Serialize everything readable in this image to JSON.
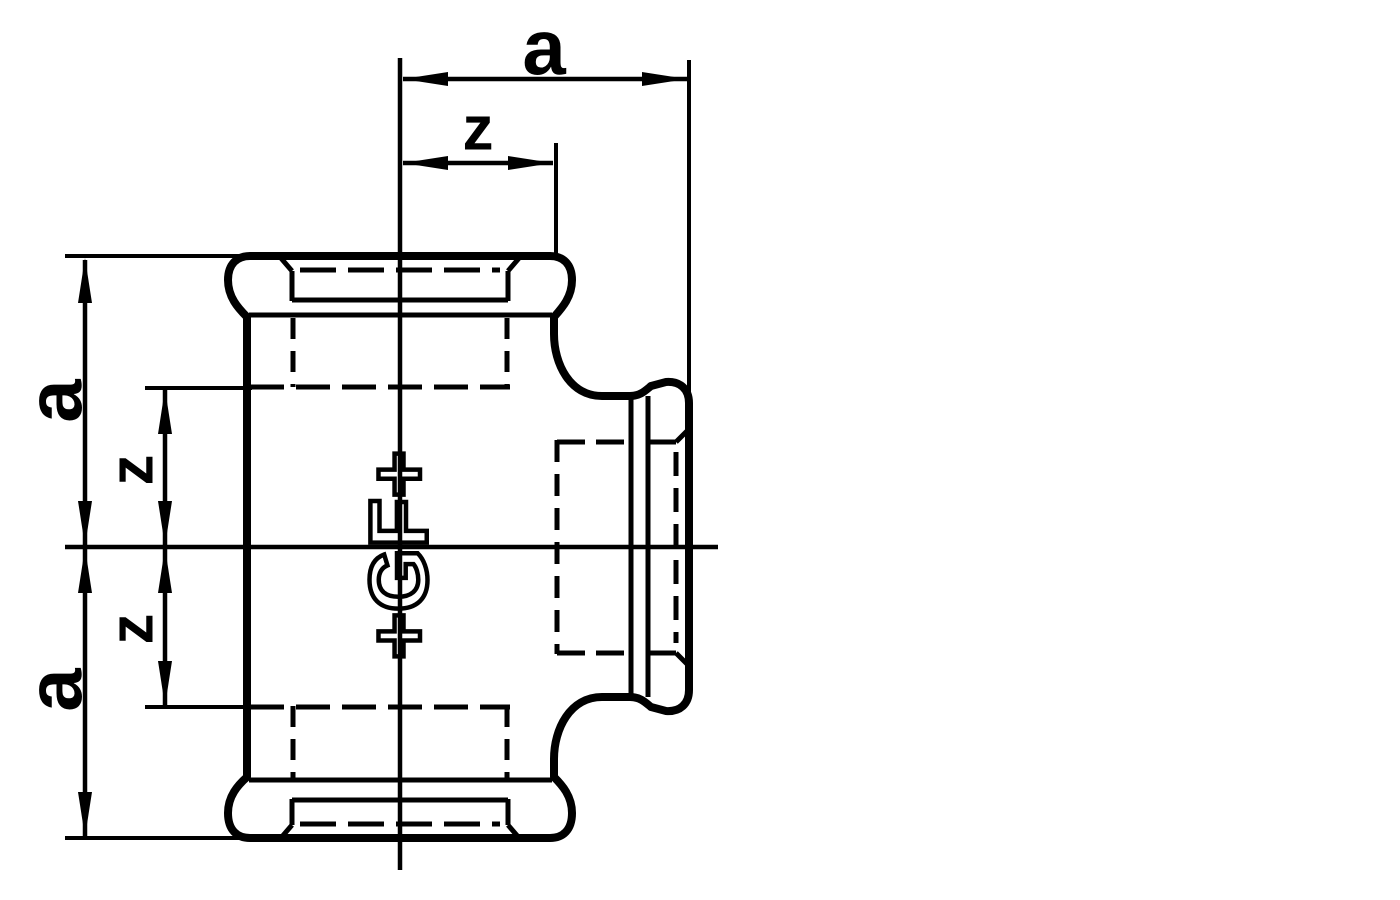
{
  "colors": {
    "ink": "#000000",
    "background": "#ffffff"
  },
  "logo": {
    "text": "+GF+"
  },
  "dimensions": {
    "top_a": "a",
    "top_z": "z",
    "left_upper_a": "a",
    "left_upper_z": "z",
    "left_lower_z": "z",
    "left_lower_a": "a"
  }
}
